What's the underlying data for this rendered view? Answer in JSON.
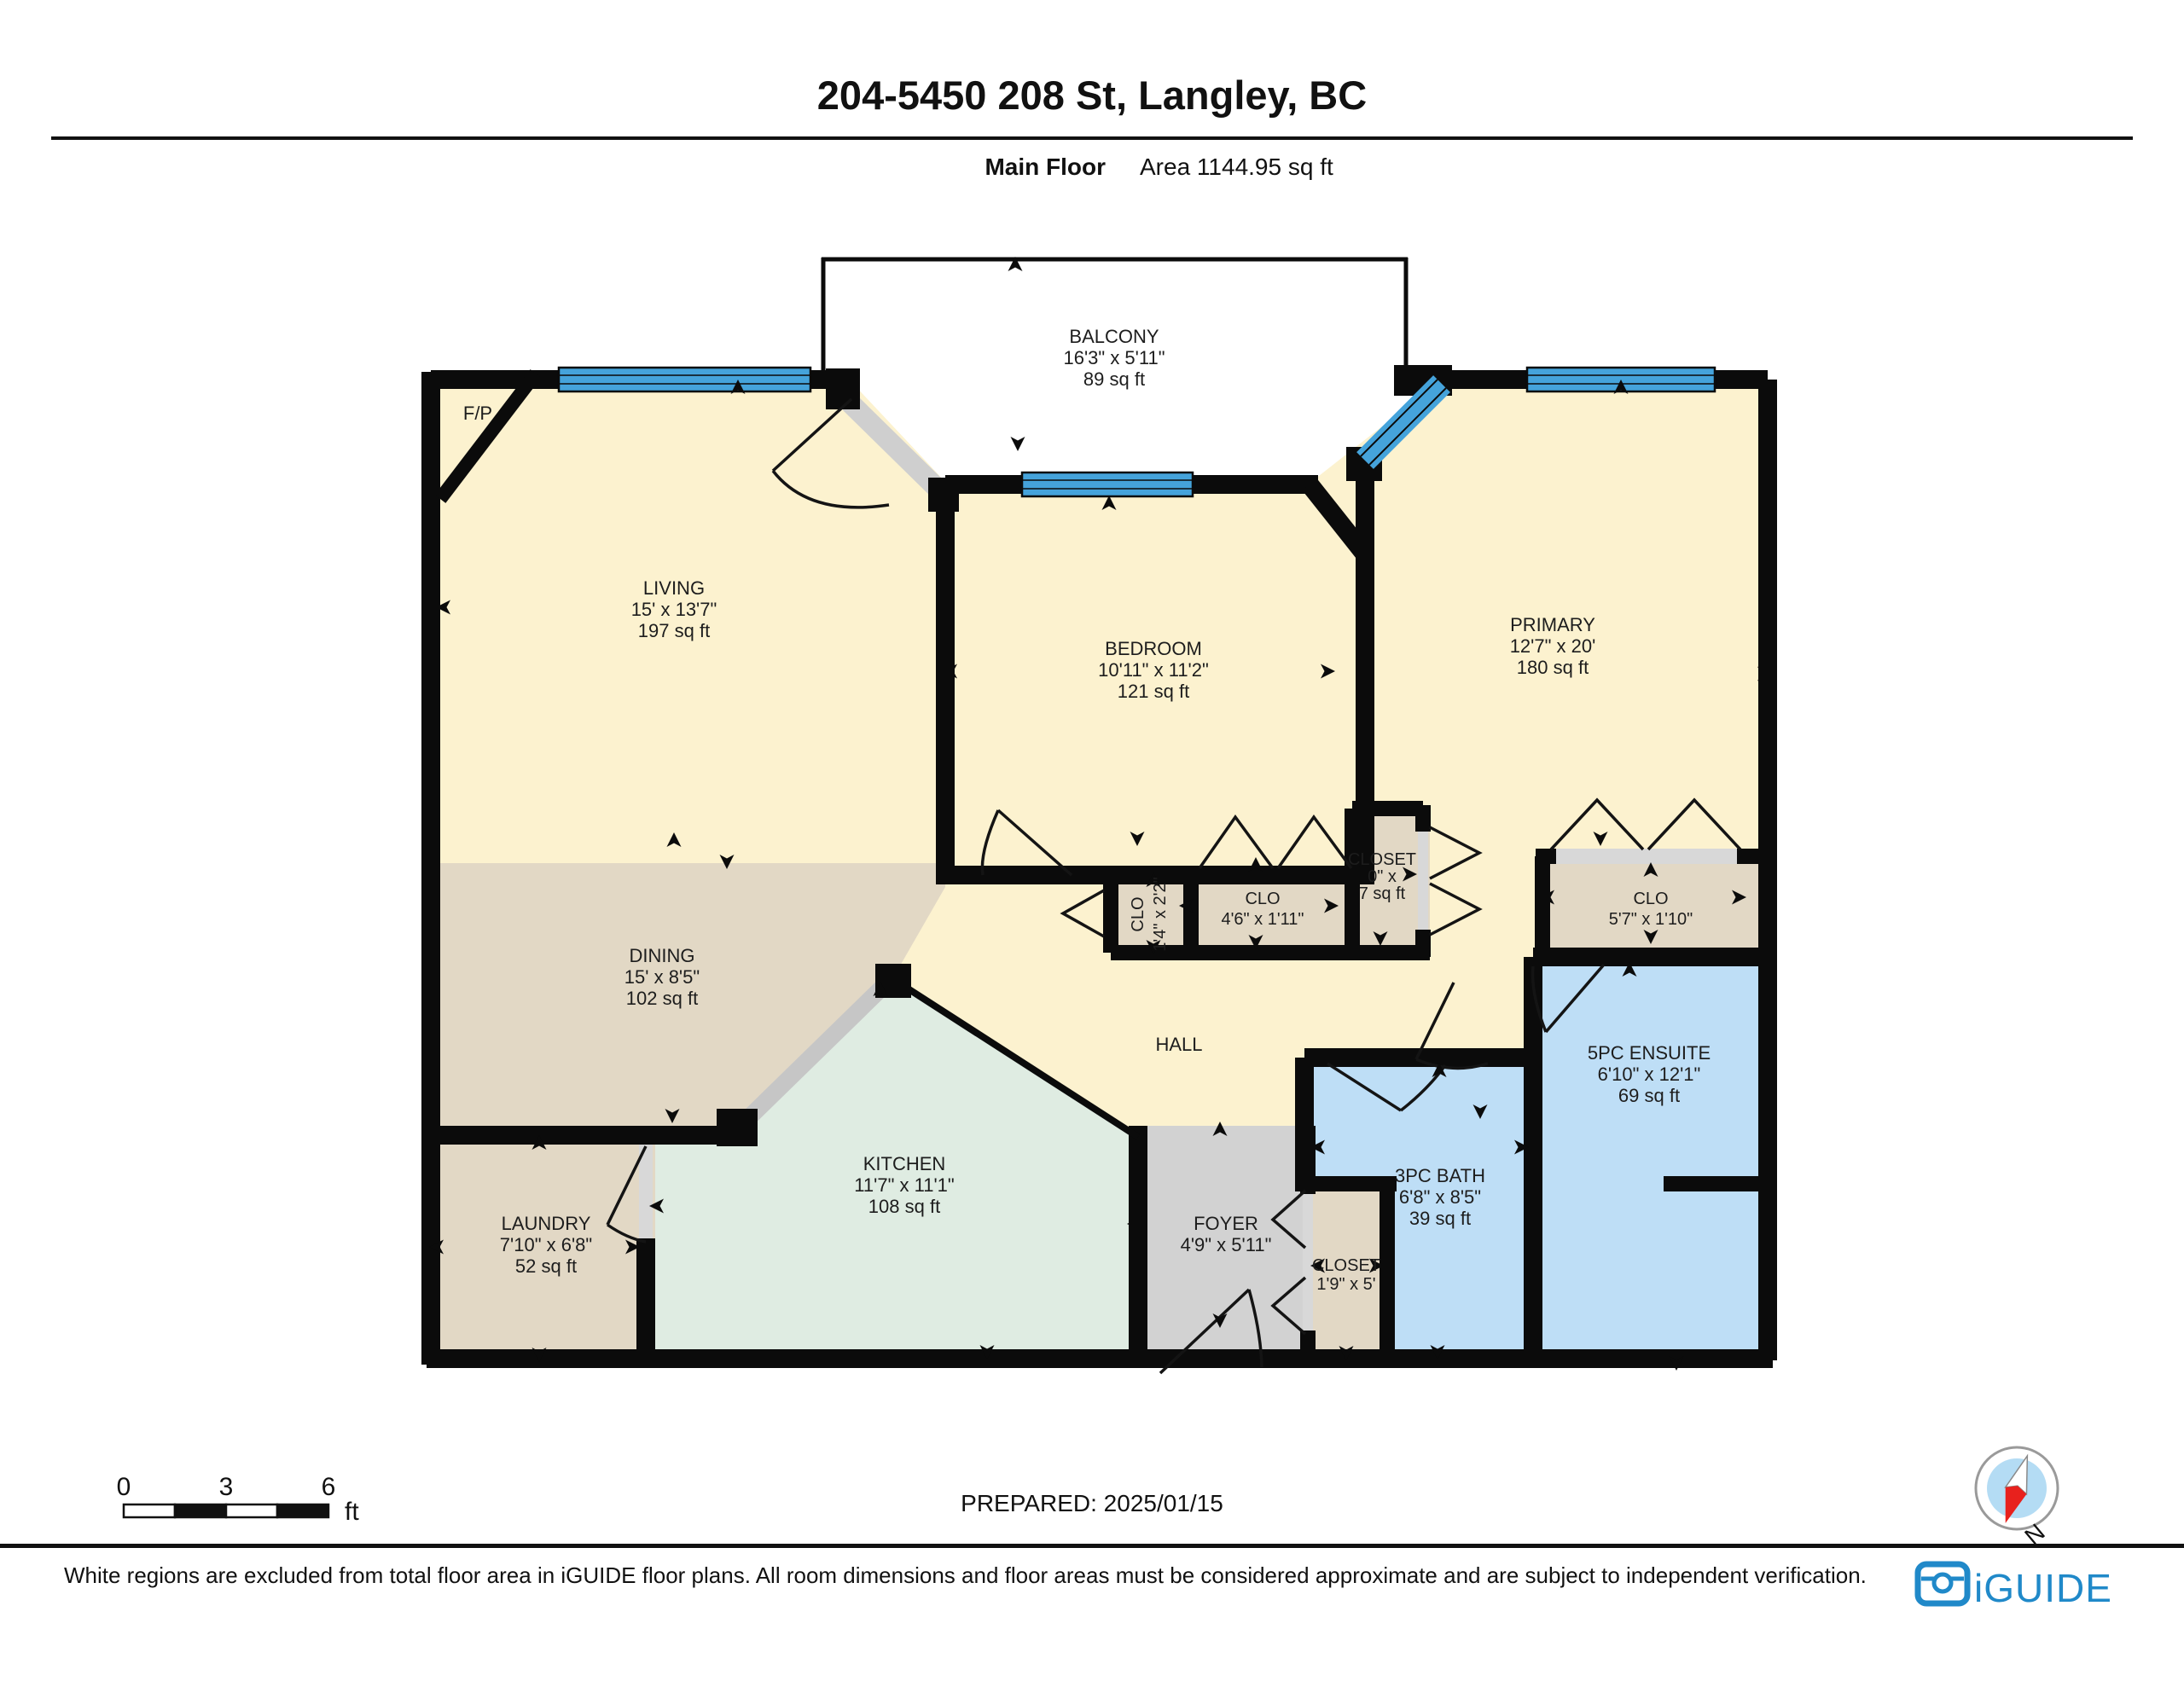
{
  "header": {
    "title": "204-5450 208 St, Langley, BC",
    "floor_label": "Main Floor",
    "area_label": "Area 1144.95 sq ft"
  },
  "rooms": {
    "balcony": {
      "name": "BALCONY",
      "dims": "16'3\" x 5'11\"",
      "area": "89 sq ft"
    },
    "living": {
      "name": "LIVING",
      "dims": "15' x 13'7\"",
      "area": "197 sq ft"
    },
    "fireplace": {
      "name": "F/P"
    },
    "bedroom": {
      "name": "BEDROOM",
      "dims": "10'11\" x 11'2\"",
      "area": "121 sq ft"
    },
    "primary": {
      "name": "PRIMARY",
      "dims": "12'7\" x 20'",
      "area": "180 sq ft"
    },
    "dining": {
      "name": "DINING",
      "dims": "15' x 8'5\"",
      "area": "102 sq ft"
    },
    "kitchen": {
      "name": "KITCHEN",
      "dims": "11'7\" x 11'1\"",
      "area": "108 sq ft"
    },
    "laundry": {
      "name": "LAUNDRY",
      "dims": "7'10\" x 6'8\"",
      "area": "52 sq ft"
    },
    "hall": {
      "name": "HALL"
    },
    "foyer": {
      "name": "FOYER",
      "dims": "4'9\" x 5'11\""
    },
    "foyer_closet": {
      "name": "CLOSET",
      "dims": "1'9\" x 5'"
    },
    "clo_small": {
      "name": "CLO",
      "dims": "1'4\" x 2'2\""
    },
    "clo_bedroom": {
      "name": "CLO",
      "dims": "4'6\" x 1'11\""
    },
    "closet_center": {
      "name": "CLOSET",
      "dims": "0\" x",
      "area": "7 sq ft"
    },
    "clo_primary": {
      "name": "CLO",
      "dims": "5'7\" x 1'10\""
    },
    "bath3pc": {
      "name": "3PC BATH",
      "dims": "6'8\" x 8'5\"",
      "area": "39 sq ft"
    },
    "ensuite": {
      "name": "5PC ENSUITE",
      "dims": "6'10\" x 12'1\"",
      "area": "69 sq ft"
    }
  },
  "scale_bar": {
    "tick0": "0",
    "tick1": "3",
    "tick2": "6",
    "unit": "ft"
  },
  "prepared": "PREPARED: 2025/01/15",
  "compass": {
    "label": "N"
  },
  "footer": {
    "disclaimer": "White regions are excluded from total floor area in iGUIDE floor plans. All room dimensions and floor areas must be considered approximate and are subject to independent verification.",
    "brand": "iGUIDE"
  },
  "colors": {
    "room_cream": "#fcf2cf",
    "room_tan": "#e2d8c5",
    "room_mint": "#dfece2",
    "room_blue": "#bedef6",
    "room_gray": "#d2d2d2",
    "window_blue": "#45a3db",
    "wall_black": "#0b0b0b",
    "brand_blue": "#2089c9",
    "compass_red": "#e8211d",
    "compass_fill": "#b4dcf4"
  }
}
